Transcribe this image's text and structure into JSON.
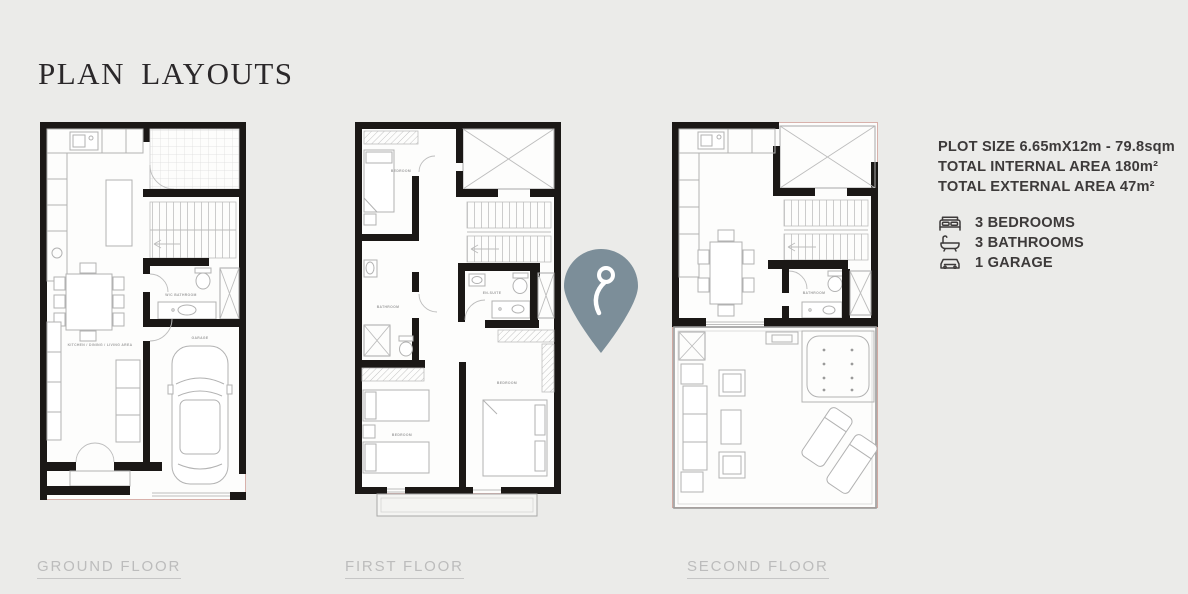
{
  "page": {
    "title": "PLAN LAYOUTS"
  },
  "details": {
    "plot_size": "PLOT SIZE 6.65mX12m - 79.8sqm",
    "internal_area": "TOTAL INTERNAL AREA 180m²",
    "external_area": "TOTAL EXTERNAL AREA 47m²",
    "features": [
      {
        "icon": "bed-icon",
        "label": "3 BEDROOMS"
      },
      {
        "icon": "bathtub-icon",
        "label": "3 BATHROOMS"
      },
      {
        "icon": "car-icon",
        "label": "1 GARAGE"
      }
    ]
  },
  "plans": [
    {
      "label": "GROUND FLOOR",
      "rooms": {
        "main": "KITCHEN / DINING / LIVING AREA",
        "wc": "W/C BATHROOM",
        "garage": "GARAGE"
      }
    },
    {
      "label": "FIRST FLOOR",
      "rooms": {
        "bedroom1": "BEDROOM",
        "bathroom": "BATHROOM",
        "ensuite": "EN-SUITE",
        "bedroom2": "BEDROOM",
        "bedroom3": "BEDROOM"
      }
    },
    {
      "label": "SECOND FLOOR",
      "rooms": {
        "bathroom": "BATHROOM"
      }
    }
  ],
  "marker": {
    "color": "#7c8e99"
  },
  "colors": {
    "background": "#ebebe9",
    "walls": "#1b1816",
    "furniture": "#b2b2b2",
    "floor_label": "#bcbcbc",
    "details_text": "#3d3a3a",
    "title": "#2b282a"
  }
}
